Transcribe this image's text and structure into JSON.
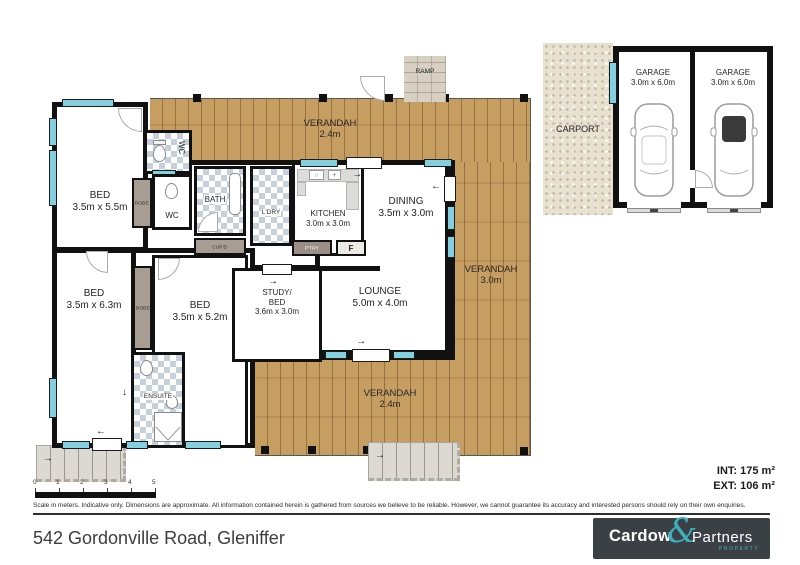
{
  "plan": {
    "rooms": {
      "bed1": {
        "name": "BED",
        "dims": "3.5m x 5.5m"
      },
      "bed2": {
        "name": "BED",
        "dims": "3.5m x 6.3m"
      },
      "bed3": {
        "name": "BED",
        "dims": "3.5m x 5.2m"
      },
      "study": {
        "name": "STUDY/",
        "name2": "BED",
        "dims": "3.6m x 3.0m"
      },
      "kitchen": {
        "name": "KITCHEN",
        "dims": "3.0m x 3.0m"
      },
      "dining": {
        "name": "DINING",
        "dims": "3.5m x 3.0m"
      },
      "lounge": {
        "name": "LOUNGE",
        "dims": "5.0m x 4.0m"
      },
      "bath": {
        "name": "BATH"
      },
      "laundry": {
        "name": "L'DRY"
      },
      "wc_upper": {
        "name": "WC"
      },
      "wc_lower": {
        "name": "WC"
      },
      "ensuite": {
        "name": "ENSUITE"
      },
      "robe1": {
        "name": "ROBE"
      },
      "robe2": {
        "name": "ROBE"
      },
      "cupboard": {
        "name": "CUP'D"
      },
      "pantry": {
        "name": "P'TRY"
      },
      "fridge": {
        "name": "F"
      },
      "ramp": {
        "name": "RAMP"
      },
      "verandah_top": {
        "name": "VERANDAH",
        "dims": "2.4m"
      },
      "verandah_right": {
        "name": "VERANDAH",
        "dims": "3.0m"
      },
      "verandah_bottom": {
        "name": "VERANDAH",
        "dims": "2.4m"
      },
      "carport": {
        "name": "CARPORT"
      },
      "garage1": {
        "name": "GARAGE",
        "dims": "3.0m x 6.0m"
      },
      "garage2": {
        "name": "GARAGE",
        "dims": "3.0m x 6.0m"
      }
    },
    "areas": {
      "internal": "INT: 175 m²",
      "external": "EXT: 106 m²"
    },
    "scale": {
      "ticks": [
        "0",
        "1",
        "2",
        "3",
        "4",
        "5"
      ]
    }
  },
  "footer": {
    "disclaimer": "Scale in meters. Indicative only. Dimensions are approximate. All information contained herein is gathered from sources we believe to be reliable. However, we cannot guarantee its accuracy and interested persons should rely on their own enquiries.",
    "address": "542 Gordonville Road, Gleniffer",
    "logo": {
      "word1": "Cardow",
      "ampersand": "&",
      "word2": "Partners",
      "tagline": "PROPERTY"
    }
  },
  "colors": {
    "wall": "#111111",
    "wood": "#c79e62",
    "window": "#84cfe0",
    "tile": "#c6d0dc",
    "robe": "#a79d93",
    "logo_bg": "#3b4045",
    "accent": "#3fafc0"
  }
}
